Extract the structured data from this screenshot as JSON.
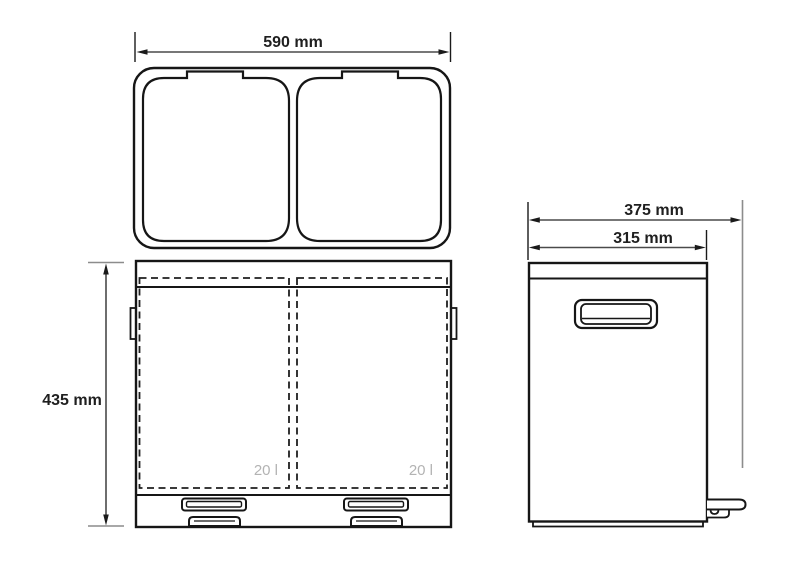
{
  "labels": {
    "dim_width_top": "590 mm",
    "dim_height_front": "435 mm",
    "dim_depth_total": "375 mm",
    "dim_depth_body": "315 mm",
    "capacity_left": "20 l",
    "capacity_right": "20 l"
  },
  "colors": {
    "background": "#ffffff",
    "outline": "#161616",
    "dimension_line": "#4a4a4a",
    "gray_extension": "#8c8c8c",
    "capacity_text": "#b3b3b3"
  }
}
